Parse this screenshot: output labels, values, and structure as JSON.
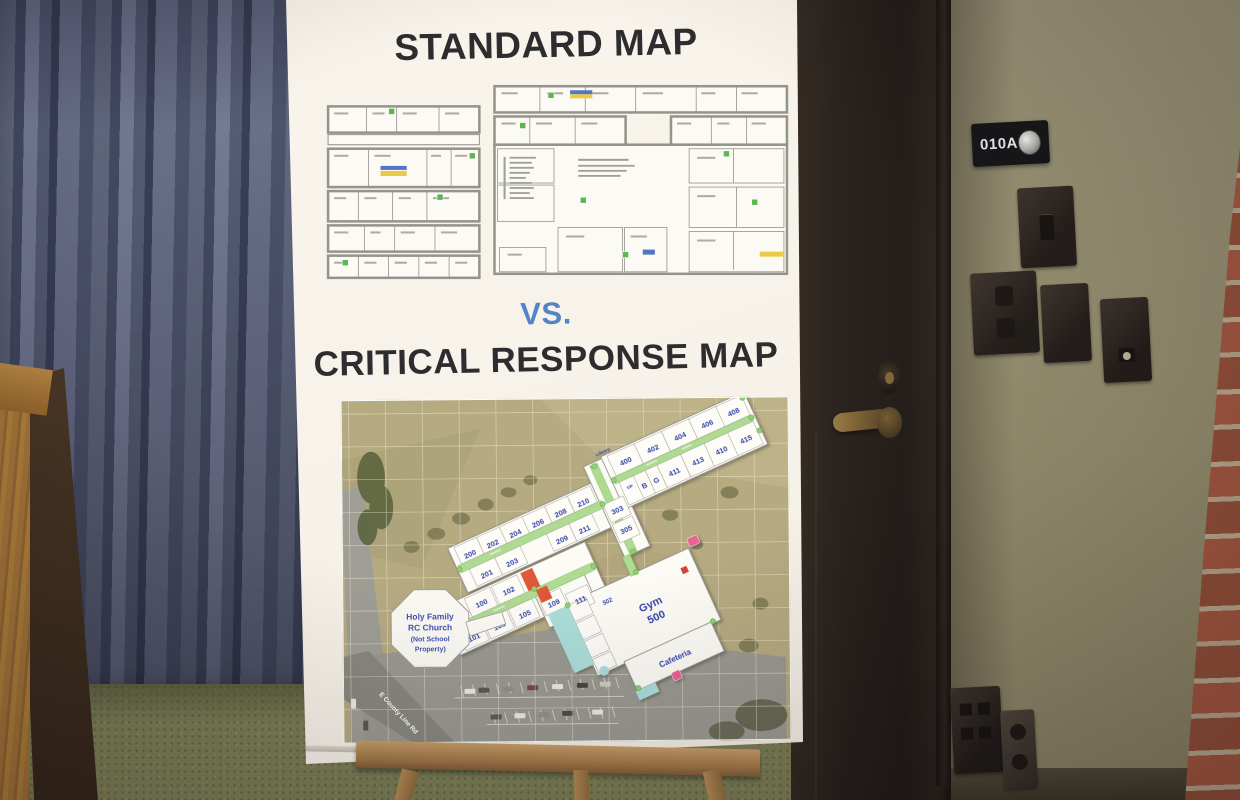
{
  "poster": {
    "title_top": "STANDARD MAP",
    "vs_label": "VS.",
    "title_bottom": "CRITICAL RESPONSE MAP"
  },
  "door_sign": {
    "label": "010A"
  },
  "critical_map": {
    "library": "Library",
    "gym_line1": "Gym",
    "gym_line2": "500",
    "cafeteria": "Cafeteria",
    "road": "E County Line Rd",
    "church_lines": [
      "Holy Family",
      "RC Church",
      "(Not School",
      "Property)"
    ],
    "rooms": [
      "100",
      "101",
      "102",
      "103",
      "105",
      "109",
      "111",
      "200",
      "201",
      "202",
      "203",
      "204",
      "206",
      "208",
      "209",
      "210",
      "211",
      "303",
      "305",
      "400",
      "402",
      "404",
      "406",
      "408",
      "410",
      "411",
      "413",
      "415",
      "502",
      "B",
      "G",
      "VP"
    ]
  },
  "colors": {
    "vs_blue": "#4a7ec6",
    "room_number_blue": "#2c3da8",
    "corridor_green": "#abd98e",
    "alert_red": "#dd4f2e",
    "walkway_teal": "#a8dcd8",
    "field_tan": "#b2a67c",
    "curtain_blue": "#4c536e",
    "brick_red": "#9e5138"
  }
}
